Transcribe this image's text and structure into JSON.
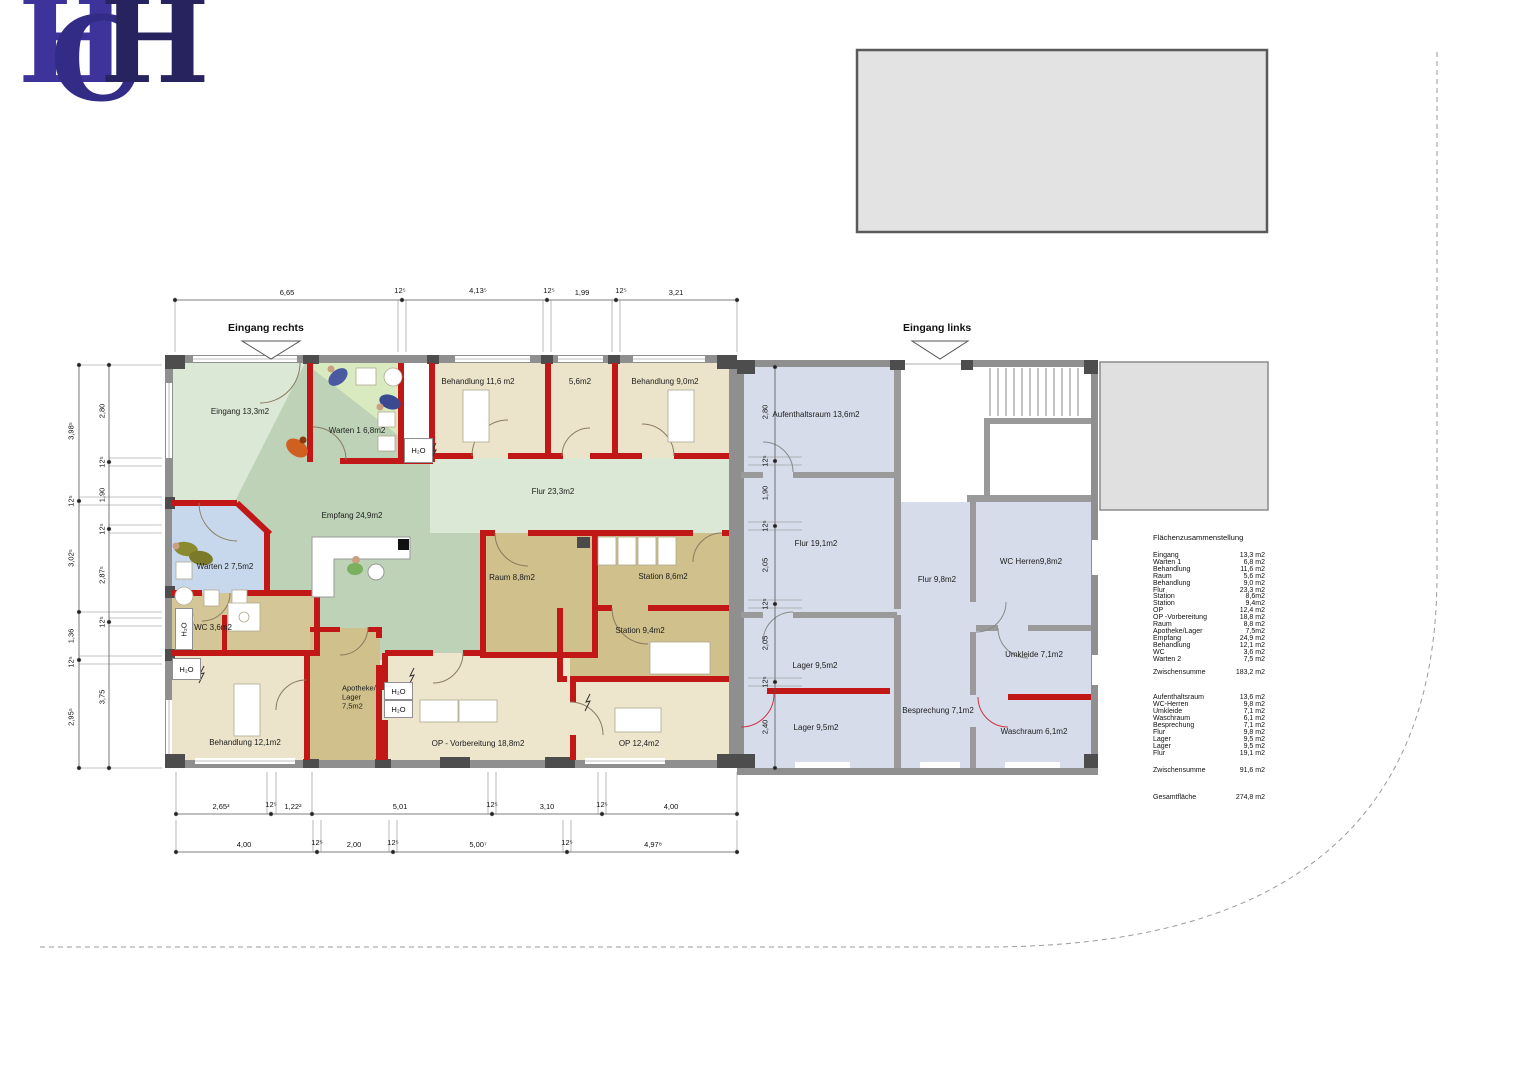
{
  "logo": {
    "l1": "H",
    "l2": "C",
    "l3": "H"
  },
  "entrances": {
    "right": "Eingang rechts",
    "left": "Eingang links"
  },
  "labels": {
    "h2o": "H₂O"
  },
  "rooms": {
    "eingang": "Eingang 13,3m2",
    "warten1": "Warten 1 6,8m2",
    "behandlung116": "Behandlung 11,6 m2",
    "raum56": "5,6m2",
    "behandlung90": "Behandlung  9,0m2",
    "flur233": "Flur 23,3m2",
    "empfang": "Empfang 24,9m2",
    "warten2": "Warten 2 7,5m2",
    "wc36": "WC 3,6m2",
    "raum88": "Raum 8,8m2",
    "station86": "Station 8,6m2",
    "station94": "Station 9,4m2",
    "behandlung121": "Behandlung 12,1m2",
    "apotheke": "Apotheke/\nLager\n7,5m2",
    "opvorb": "OP - Vorbereitung 18,8m2",
    "op124": "OP 12,4m2",
    "aufenthalt": "Aufenthaltsraum 13,6m2",
    "flur191": "Flur 19,1m2",
    "flur98": "Flur 9,8m2",
    "wcherren": "WC Herren9,8m2",
    "lager1": "Lager 9,5m2",
    "lager2": "Lager 9,5m2",
    "besprechung": "Besprechung 7,1m2",
    "umkleide": "Umkleide 7,1m2",
    "waschraum": "Waschraum 6,1m2"
  },
  "dims": {
    "top": [
      "6,65",
      "12⁵",
      "4,13⁵",
      "12⁵",
      "1,99",
      "12⁵",
      "3,21"
    ],
    "bottom1": [
      "2,65³",
      "12⁵",
      "1,22²",
      "5,01",
      "12⁵",
      "3,10",
      "12⁵",
      "4,00"
    ],
    "bottom2": [
      "4,00",
      "12⁵",
      "2,00",
      "12⁵",
      "5,00⁷",
      "12⁵",
      "4,97⁸"
    ],
    "left_outer": [
      "3,98⁵",
      "12⁵",
      "3,02⁵",
      "1,36",
      "12⁵",
      "2,95⁵"
    ],
    "left_inner": [
      "2,80",
      "12⁵",
      "1,90",
      "12⁵",
      "2,87⁵",
      "12⁵",
      "3,75"
    ],
    "right_inner": [
      "2,80",
      "12⁵",
      "1,90",
      "12⁵",
      "2,05",
      "12⁵",
      "2,05",
      "12⁵",
      "2,40"
    ]
  },
  "summary": {
    "title": "Flächenzusammenstellung",
    "rows1": [
      {
        "n": "Eingang",
        "v": "13,3 m2"
      },
      {
        "n": "Warten 1",
        "v": "6,8 m2"
      },
      {
        "n": "Behandlung",
        "v": "11,6 m2"
      },
      {
        "n": "Raum",
        "v": "5,6 m2"
      },
      {
        "n": "Behandlung",
        "v": "9,0 m2"
      },
      {
        "n": "Flur",
        "v": "23,3 m2"
      },
      {
        "n": "Station",
        "v": "8,6m2"
      },
      {
        "n": "Station",
        "v": "9,4m2"
      },
      {
        "n": "OP",
        "v": "12,4 m2"
      },
      {
        "n": "OP -Vorbereitung",
        "v": "18,8 m2"
      },
      {
        "n": "Raum",
        "v": "8,8 m2"
      },
      {
        "n": "Apotheke/Lager",
        "v": "7,5m2"
      },
      {
        "n": "Empfang",
        "v": "24,9 m2"
      },
      {
        "n": "Behandlung",
        "v": "12,1 m2"
      },
      {
        "n": "WC",
        "v": "3,6 m2"
      },
      {
        "n": "Warten 2",
        "v": "7,5 m2"
      }
    ],
    "subtotal_label": "Zwischensumme",
    "subtotal1": "183,2 m2",
    "rows2": [
      {
        "n": "Aufenthaltsraum",
        "v": "13,6 m2"
      },
      {
        "n": "WC-Herren",
        "v": "9,8 m2"
      },
      {
        "n": "Umkleide",
        "v": "7,1 m2"
      },
      {
        "n": "Waschraum",
        "v": "6,1 m2"
      },
      {
        "n": "Besprechung",
        "v": "7,1 m2"
      },
      {
        "n": "Flur",
        "v": "9,8 m2"
      },
      {
        "n": "Lager",
        "v": "9,5 m2"
      },
      {
        "n": "Lager",
        "v": "9,5 m2"
      },
      {
        "n": "Flur",
        "v": "19,1 m2"
      }
    ],
    "subtotal2": "91,6 m2",
    "total_label": "Gesamtfläche",
    "total": "274,8 m2"
  }
}
